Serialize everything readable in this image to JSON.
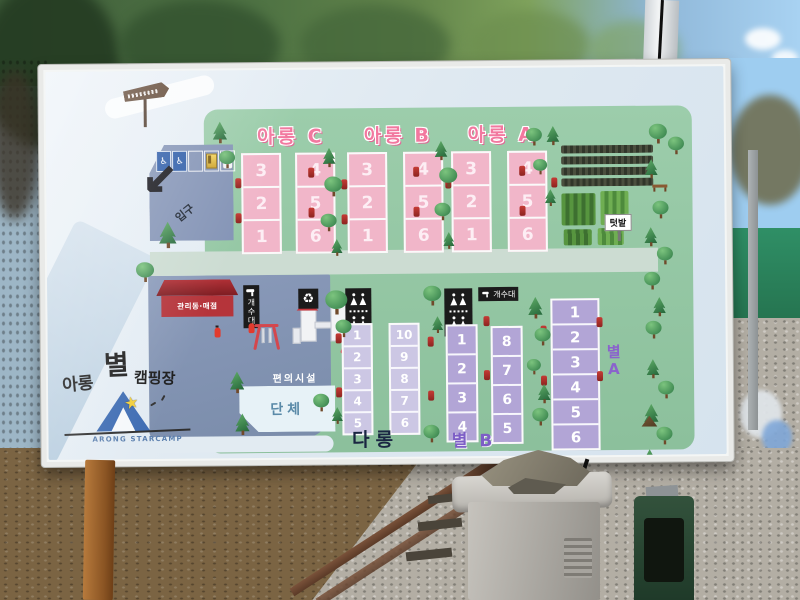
{
  "sign": {
    "logo": {
      "korean_part1": "아롱",
      "korean_part2": "별",
      "korean_part3": "캠핑장",
      "english": "ARONG STARCAMP"
    },
    "entrance_label": "입구",
    "parking_symbol": "P",
    "icons": {
      "wheelchair": "♿",
      "recycle": "♻",
      "arrow_down_left": "↙",
      "star": "★"
    },
    "sections_top": [
      {
        "title": "아롱 C",
        "col_left": [
          "3",
          "2",
          "1"
        ],
        "col_right": [
          "4",
          "5",
          "6"
        ]
      },
      {
        "title": "아롱 B",
        "col_left": [
          "3",
          "2",
          "1"
        ],
        "col_right": [
          "4",
          "5",
          "6"
        ]
      },
      {
        "title": "아롱 A",
        "col_left": [
          "3",
          "2",
          "1"
        ],
        "col_right": [
          "4",
          "5",
          "6"
        ]
      }
    ],
    "garden_label": "텃밭",
    "management_label": "관리동·매점",
    "sink_label_vertical": "개수대",
    "sink_label_horizontal": "개수대",
    "facilities_label": "편의시설",
    "group_label": "단체",
    "sections_bottom": [
      {
        "title": "다롱",
        "col_left": [
          "1",
          "2",
          "3",
          "4",
          "5"
        ],
        "col_right": [
          "10",
          "9",
          "8",
          "7",
          "6"
        ]
      },
      {
        "title": "별 B",
        "col_left": [
          "1",
          "2",
          "3",
          "4"
        ],
        "col_right": [
          "8",
          "7",
          "6",
          "5"
        ]
      },
      {
        "title_line1": "별",
        "title_line2": "A",
        "col": [
          "1",
          "2",
          "3",
          "4",
          "5",
          "6"
        ]
      }
    ]
  },
  "colors": {
    "map_green": "#95c8a5",
    "site_pink": "#f1b6c9",
    "pink_title": "#f2789f",
    "site_lavender_light": "#ccc7e4",
    "site_lavender_dark": "#b2a5d6",
    "purple_label": "#7d5ec6",
    "navy_label": "#1a2642",
    "zone_blue": "#8494b6",
    "sign_black": "#1b1b1b",
    "building_red": "#b5343a"
  }
}
